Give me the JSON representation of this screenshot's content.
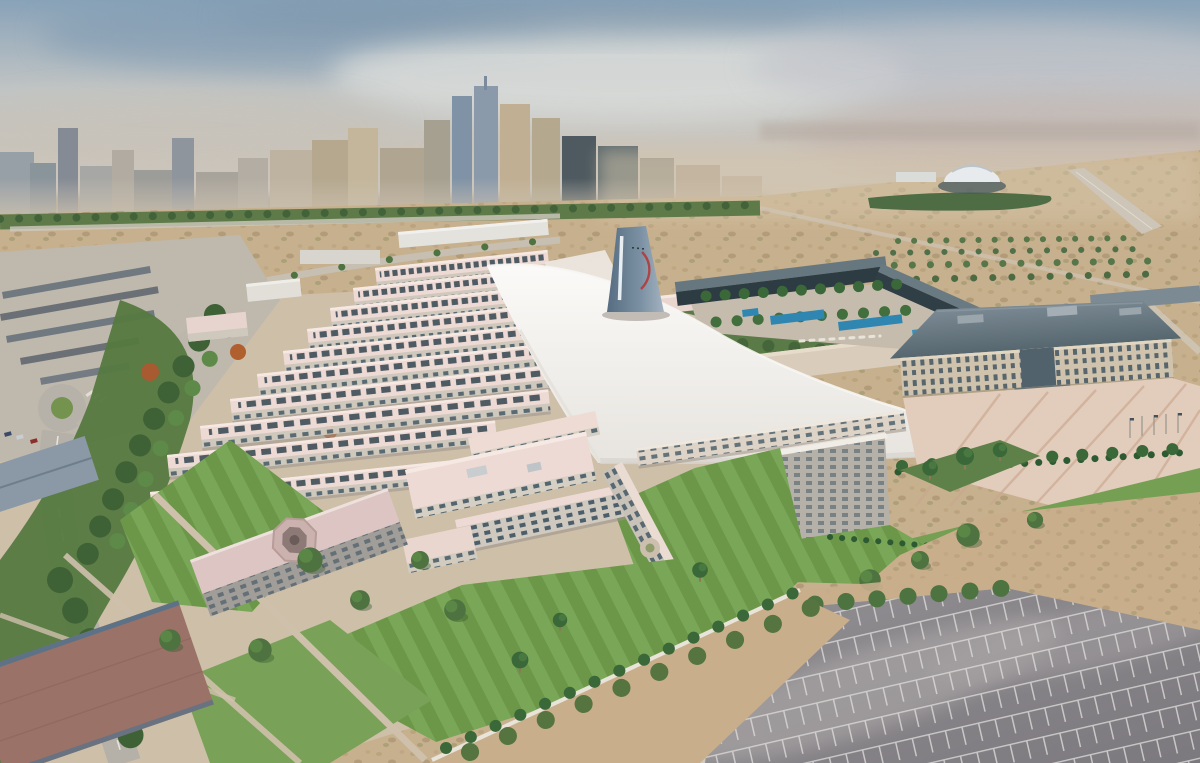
{
  "scene": {
    "type": "aerial-photograph",
    "setting": "large desert-city university campus viewed from the air on a hazy day",
    "elements": [
      "hazy grey-blue sky",
      "distant high-rise city skyline",
      "desert scrubland with tree belts",
      "white domed arena",
      "fan of parallel campus wings with pale pink roofs",
      "large white curved sail canopy roof",
      "blue-grey conical tower with red swoosh",
      "courtyard with palm trees and blue swimming pools",
      "administration building with grey hipped roof",
      "pink plaza with radiating stripes and flagpoles",
      "palm rows, hedges and striped lawns",
      "hall with octagonal skylight",
      "tree-lined roads and walkways",
      "shade-canopy car park",
      "large empty parking lot with white bay lines",
      "sand strips"
    ]
  },
  "palette": {
    "sky_top": "#88a2b8",
    "sky_haze": "#cfc8be",
    "cloud": "#d9dbd9",
    "city_grey": "#9aa3a8",
    "city_tan": "#c0b092",
    "desert": "#c7b08d",
    "scrub": "#5f7a49",
    "tree_dark": "#3f6136",
    "tree_mid": "#4e7340",
    "tree_light": "#6f9850",
    "flower_red": "#a85a30",
    "road_grey": "#b5b0a8",
    "path_tan": "#cfc0ac",
    "campus_ground": "#cdbfa8",
    "roof_pink": "#eedad4",
    "roof_pink_light": "#f6e9e3",
    "wall_cream": "#d9d2c7",
    "wall_grey": "#b4aea6",
    "window_dark": "#3c5260",
    "sail_white": "#f7f6f3",
    "sail_shade": "#d8d4cf",
    "tower_blue": "#6e8397",
    "tower_blue_light": "#a3b2bf",
    "tower_red": "#b23a3a",
    "glass_dark": "#2d3b43",
    "glass_roof": "#67777f",
    "pool_blue": "#2f86b0",
    "lawn_green": "#75a054",
    "lawn_green_dark": "#69944a",
    "plaza_pink": "#e2ccbc",
    "plaza_stripe": "#c9a78f",
    "admin_wall": "#cfc3ad",
    "admin_roof": "#677984",
    "asphalt": "#8a878b",
    "asphalt_light": "#b3afae",
    "parking_line": "#dcdad8",
    "sand": "#c9ae8c",
    "octagon_roof": "#dcc5c3",
    "corner_roof": "#9b7268",
    "blue_roof": "#8b99a6"
  }
}
